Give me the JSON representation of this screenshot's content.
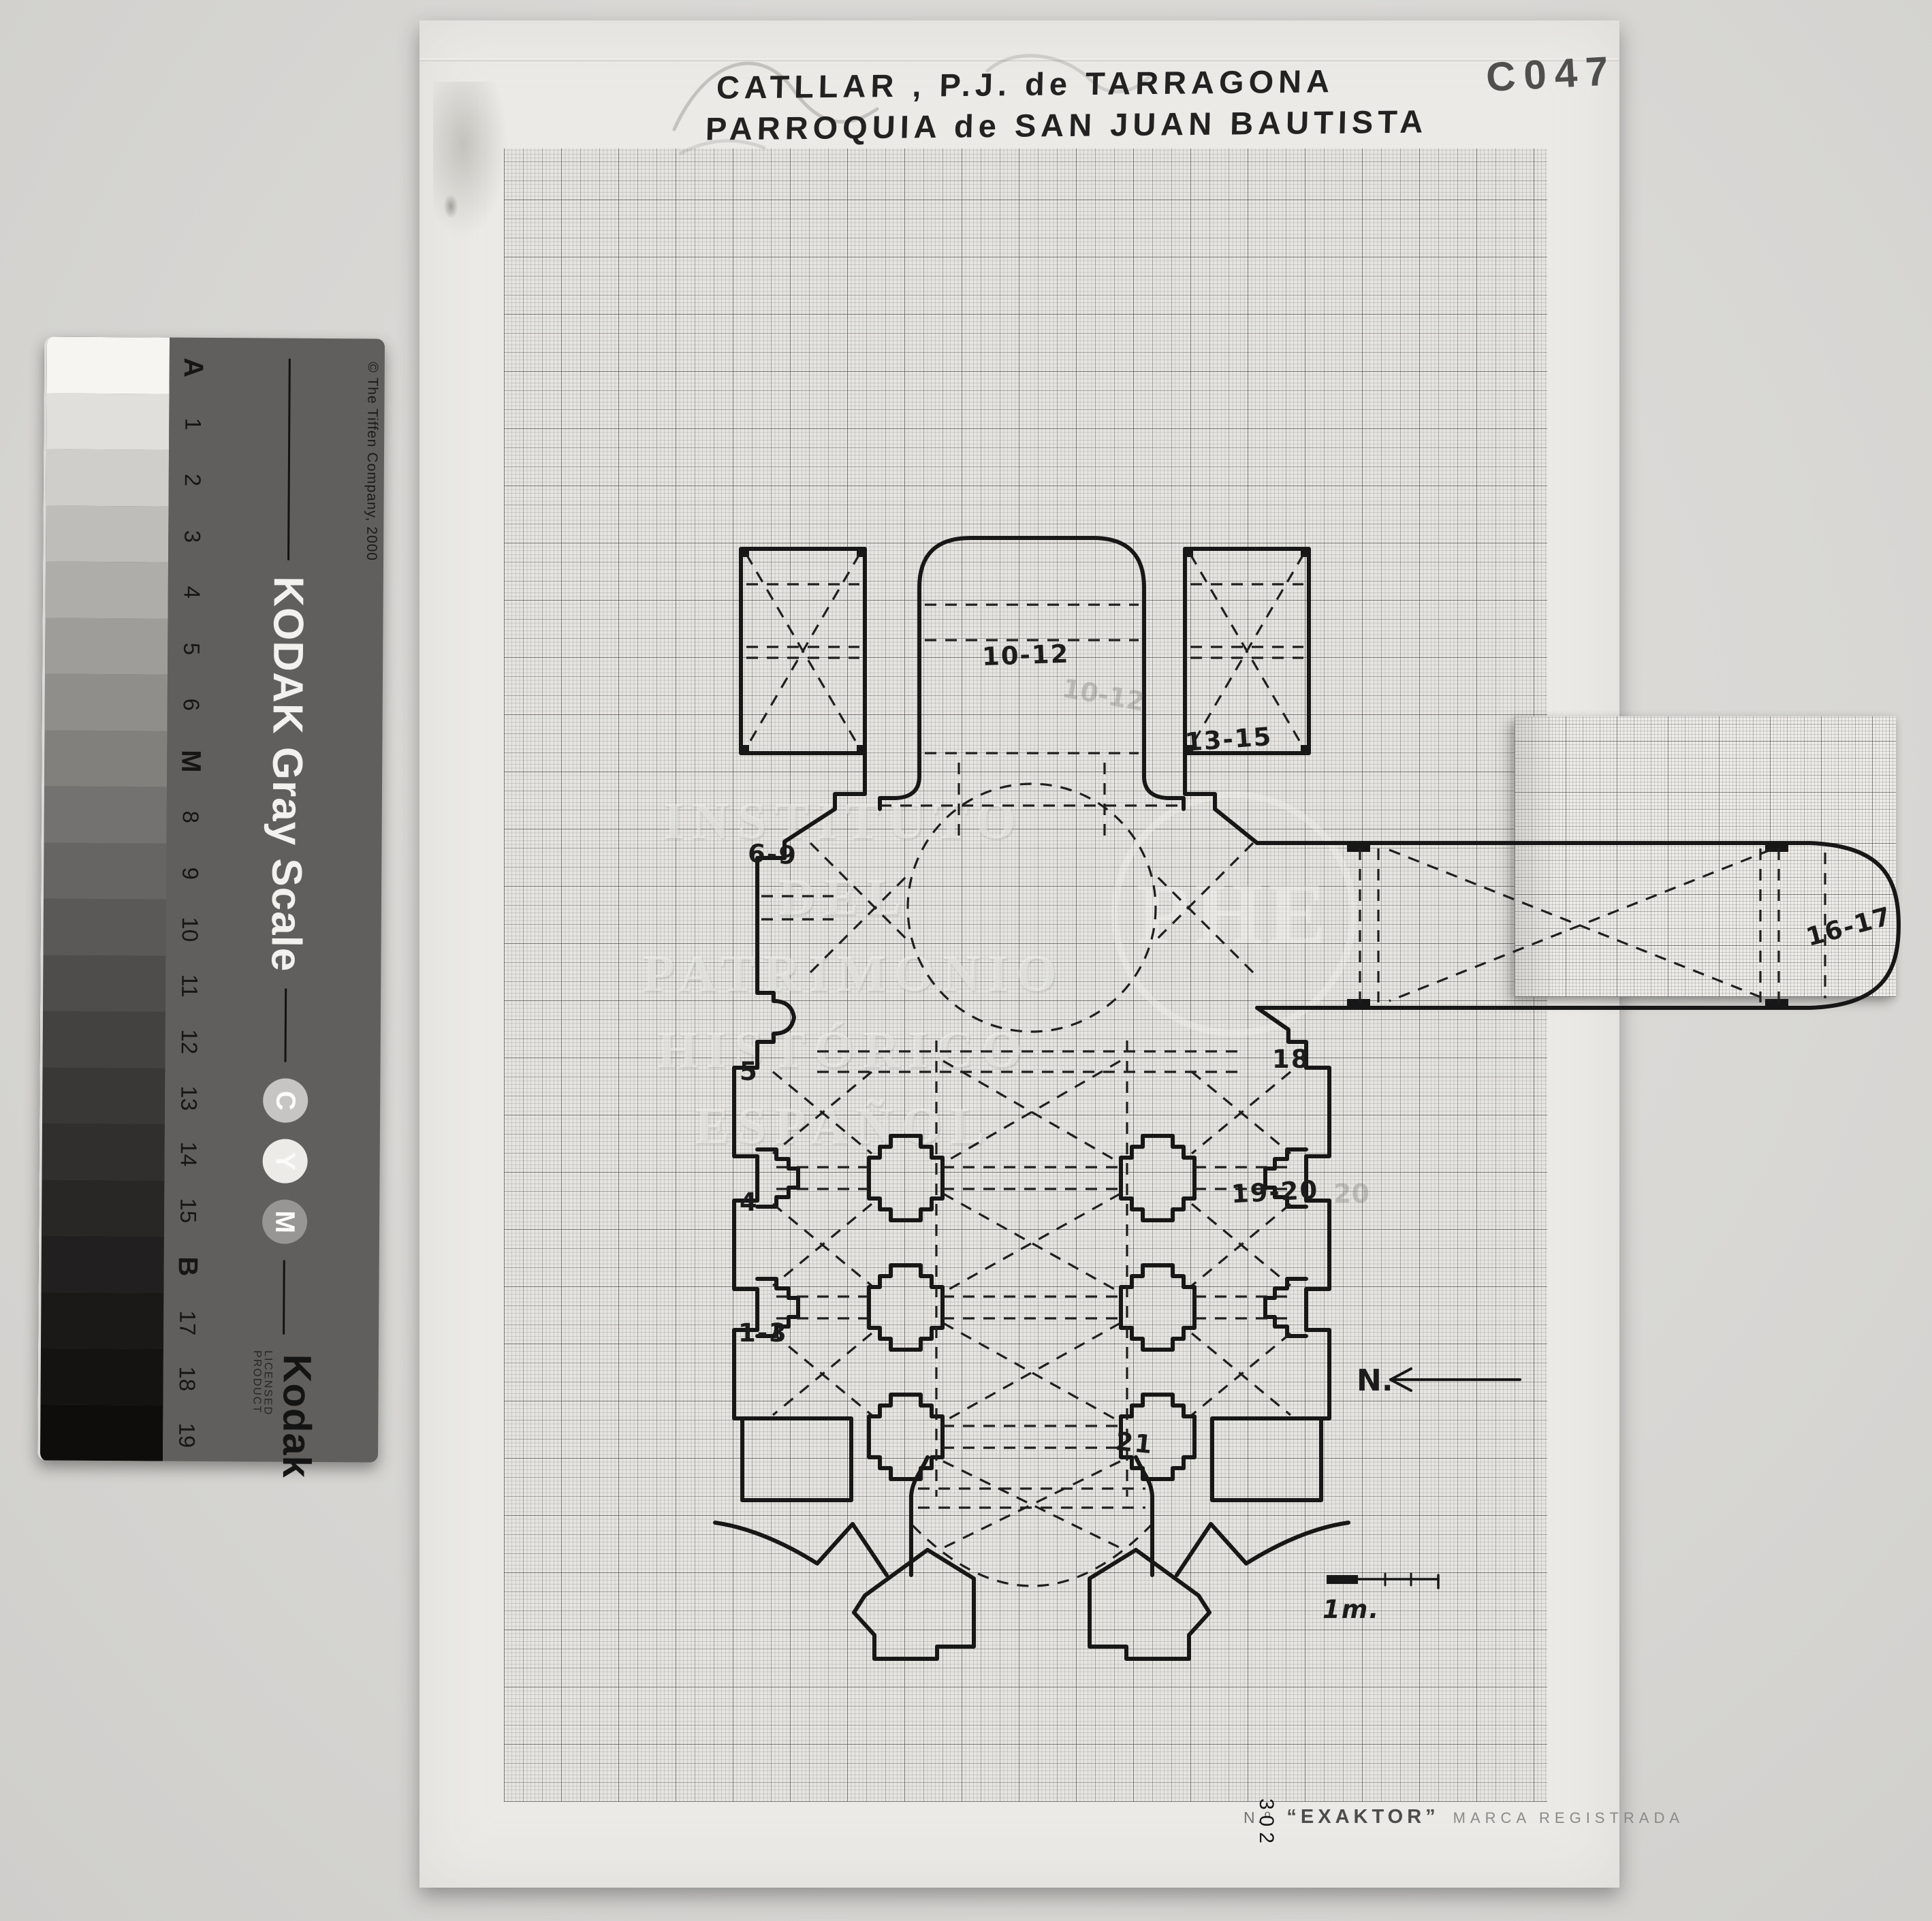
{
  "archive_code": "C047",
  "title": {
    "line1": "CATLLAR , P.J. de TARRAGONA",
    "line2": "PARROQUIA de SAN JUAN BAUTISTA"
  },
  "plan": {
    "labels": [
      {
        "id": "10-12",
        "text": "10-12"
      },
      {
        "id": "13-15",
        "text": "13-15"
      },
      {
        "id": "6-9",
        "text": "6-9"
      },
      {
        "id": "16-17",
        "text": "16-17"
      },
      {
        "id": "5",
        "text": "5"
      },
      {
        "id": "18",
        "text": "18"
      },
      {
        "id": "4",
        "text": "4"
      },
      {
        "id": "19-20",
        "text": "19-20"
      },
      {
        "id": "1-3",
        "text": "1-3"
      },
      {
        "id": "21",
        "text": "21"
      }
    ],
    "ghost_labels": [
      {
        "text": "10-12"
      },
      {
        "text": "20"
      }
    ],
    "north_label": "N.",
    "scale_label": "1m."
  },
  "watermark": {
    "line1": "INSTITUTO",
    "line2": "DEL",
    "line3": "PATRIMONIO",
    "line4": "HISTÓRICO",
    "line5": "ESPAÑOL",
    "monogram": "PHE"
  },
  "imprint": {
    "number_prefix": "N.º",
    "number": "302",
    "brand": "“EXAKTOR”",
    "note": "MARCA REGISTRADA"
  },
  "gray_scale": {
    "copyright": "© The Tiffen Company, 2000",
    "product": "KODAK Gray Scale",
    "logo": "Kodak",
    "licensed": "LICENSED PRODUCT",
    "cym": [
      {
        "label": "C",
        "color": "#c6c5c3"
      },
      {
        "label": "Y",
        "color": "#edebe8"
      },
      {
        "label": "M",
        "color": "#989694"
      }
    ],
    "steps": [
      {
        "label": "A",
        "color": "#f6f5f2"
      },
      {
        "label": "1",
        "color": "#e0dfdc"
      },
      {
        "label": "2",
        "color": "#cfcecb"
      },
      {
        "label": "3",
        "color": "#bebdba"
      },
      {
        "label": "4",
        "color": "#aeadaa"
      },
      {
        "label": "5",
        "color": "#9e9d9a"
      },
      {
        "label": "6",
        "color": "#8f8e8b"
      },
      {
        "label": "M",
        "color": "#81807d"
      },
      {
        "label": "8",
        "color": "#737270"
      },
      {
        "label": "9",
        "color": "#666563"
      },
      {
        "label": "10",
        "color": "#5a5957"
      },
      {
        "label": "11",
        "color": "#4e4d4b"
      },
      {
        "label": "12",
        "color": "#434241"
      },
      {
        "label": "13",
        "color": "#393837"
      },
      {
        "label": "14",
        "color": "#302f2e"
      },
      {
        "label": "15",
        "color": "#282726"
      },
      {
        "label": "B",
        "color": "#211f1f"
      },
      {
        "label": "17",
        "color": "#1a1918"
      },
      {
        "label": "18",
        "color": "#141312"
      },
      {
        "label": "19",
        "color": "#0e0d0c"
      }
    ]
  },
  "colors": {
    "ink": "#171717",
    "paper": "#ebeae6",
    "card_band": "#605f5d"
  }
}
